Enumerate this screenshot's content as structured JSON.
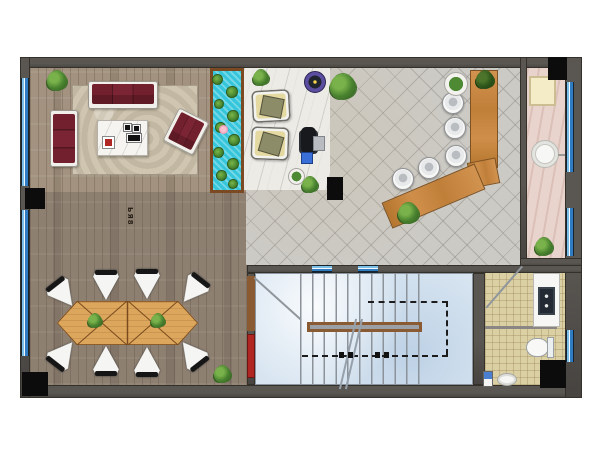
{
  "document": {
    "type": "architectural floor plan, top view, furnished office/showroom level",
    "watermark": "ЬЯ8"
  },
  "colors": {
    "wall": "#5a5652",
    "wall_dark": "#474340",
    "wood": "#a2927f",
    "tile": "#cccac5",
    "marble": "#edebe6",
    "pond_water": "#35c6dc",
    "pond_frame": "#7c4a22",
    "rug": "#cfc5b0",
    "maroon": "#7b2433",
    "cream": "#e5d9a2",
    "desk_edge": "#7e5222",
    "table_wood": "#dca75c",
    "table_line": "#7a4a1e",
    "stairs": "#d8e5f1",
    "tread": "#8b9299",
    "railing": "#8a5a32",
    "bath_floor": "#dbcfa4",
    "pink_floor": "#e8d4cc",
    "window_blue": "#2f7cc2",
    "accent_red": "#b02622",
    "chair_white": "#f5f5f3"
  },
  "rooms": [
    {
      "id": "living-lounge",
      "floor": "wood planks",
      "furniture": [
        "3-seat maroon sofa",
        "maroon chaise",
        "maroon armchair",
        "white coffee table",
        "area rug",
        "plant"
      ]
    },
    {
      "id": "lily-pond",
      "floor": "water feature with lily pads"
    },
    {
      "id": "marble-hall",
      "floor": "white marble",
      "furniture": [
        "2 beige armchairs",
        "office chair",
        "side table",
        "blue crate",
        "purple bowl",
        "planters"
      ]
    },
    {
      "id": "reception-lobby",
      "floor": "diagonal gray tile",
      "furniture": [
        "L-shaped wood bar desk",
        "5 round stools",
        "plants"
      ]
    },
    {
      "id": "side-corridor",
      "floor": "rose marble",
      "furniture": [
        "cream cabinet",
        "round basin",
        "plant"
      ]
    },
    {
      "id": "conference-area",
      "floor": "dark wood planks",
      "furniture": [
        "hexagonal double table",
        "8 white cone chairs",
        "2 table plants"
      ]
    },
    {
      "id": "stairwell",
      "floor": "blue marble",
      "furniture": [
        "stair treads",
        "railing",
        "up-path dashed arrows",
        "door"
      ]
    },
    {
      "id": "bathroom",
      "floor": "beige mosaic",
      "furniture": [
        "vanity with sink",
        "toilet",
        "small sink",
        "cabinet"
      ]
    }
  ],
  "repeats": {
    "windows_left": {
      "cls": "win-v",
      "name": "window-left",
      "items": [
        {
          "x": 21,
          "y": 78,
          "w": 8,
          "h": 108
        },
        {
          "x": 21,
          "y": 210,
          "w": 8,
          "h": 146
        }
      ]
    },
    "windows_right": {
      "cls": "win-v",
      "name": "window-right",
      "items": [
        {
          "x": 566,
          "y": 82,
          "w": 8,
          "h": 90
        },
        {
          "x": 566,
          "y": 208,
          "w": 8,
          "h": 48
        },
        {
          "x": 566,
          "y": 330,
          "w": 8,
          "h": 32
        }
      ]
    },
    "stair_glass": {
      "cls": "win-h",
      "name": "stair-glass-panel",
      "items": [
        {
          "x": 312,
          "y": 265,
          "w": 20,
          "h": 8
        },
        {
          "x": 358,
          "y": 265,
          "w": 20,
          "h": 8
        }
      ]
    },
    "columns": {
      "cls": "col-black",
      "name": "structural-column",
      "items": [
        {
          "x": 25,
          "y": 188,
          "w": 20,
          "h": 21
        },
        {
          "x": 22,
          "y": 372,
          "w": 26,
          "h": 24
        },
        {
          "x": 327,
          "y": 177,
          "w": 16,
          "h": 23
        },
        {
          "x": 548,
          "y": 57,
          "w": 19,
          "h": 23
        },
        {
          "x": 540,
          "y": 360,
          "w": 26,
          "h": 28
        }
      ]
    },
    "stools": {
      "cls": "stool",
      "name": "reception-stool",
      "items": [
        {
          "x": 392,
          "y": 168,
          "d": 22
        },
        {
          "x": 418,
          "y": 157,
          "d": 22
        },
        {
          "x": 445,
          "y": 145,
          "d": 22
        },
        {
          "x": 444,
          "y": 117,
          "d": 22
        },
        {
          "x": 442,
          "y": 92,
          "d": 22
        }
      ]
    },
    "conf_chairs": {
      "cls": "conf-chair",
      "name": "conference-chair",
      "items": [
        {
          "x": 49,
          "y": 279,
          "w": 28,
          "h": 30,
          "r": -38
        },
        {
          "x": 92,
          "y": 270,
          "w": 28,
          "h": 30,
          "r": 0
        },
        {
          "x": 133,
          "y": 269,
          "w": 28,
          "h": 30,
          "r": 0
        },
        {
          "x": 179,
          "y": 275,
          "w": 28,
          "h": 30,
          "r": 38
        },
        {
          "x": 49,
          "y": 339,
          "w": 28,
          "h": 30,
          "r": 218
        },
        {
          "x": 92,
          "y": 346,
          "w": 28,
          "h": 30,
          "r": 180
        },
        {
          "x": 133,
          "y": 347,
          "w": 28,
          "h": 30,
          "r": 180
        },
        {
          "x": 178,
          "y": 339,
          "w": 28,
          "h": 30,
          "r": 142
        }
      ]
    },
    "lily_pads": {
      "cls": "pad",
      "name": "lily-pad",
      "items": [
        {
          "x": 212,
          "y": 74,
          "d": 11
        },
        {
          "x": 226,
          "y": 86,
          "d": 12
        },
        {
          "x": 214,
          "y": 99,
          "d": 10
        },
        {
          "x": 227,
          "y": 110,
          "d": 12
        },
        {
          "x": 215,
          "y": 122,
          "d": 11
        },
        {
          "x": 228,
          "y": 134,
          "d": 12
        },
        {
          "x": 213,
          "y": 147,
          "d": 11
        },
        {
          "x": 227,
          "y": 158,
          "d": 12
        },
        {
          "x": 216,
          "y": 170,
          "d": 11
        },
        {
          "x": 228,
          "y": 179,
          "d": 10
        }
      ]
    },
    "flowers": {
      "cls": "flower",
      "name": "lotus-flower",
      "items": [
        {
          "x": 219,
          "y": 125,
          "d": 9
        }
      ]
    },
    "plants": {
      "cls": "plant",
      "name": "plant",
      "items": [
        {
          "x": 47,
          "y": 71,
          "d": 20
        },
        {
          "x": 253,
          "y": 70,
          "d": 16
        },
        {
          "x": 330,
          "y": 74,
          "d": 26
        },
        {
          "x": 444,
          "y": 72,
          "d": 24,
          "v": "planter"
        },
        {
          "x": 476,
          "y": 71,
          "d": 18,
          "v": "dark"
        },
        {
          "x": 398,
          "y": 203,
          "d": 21
        },
        {
          "x": 535,
          "y": 238,
          "d": 18
        },
        {
          "x": 214,
          "y": 366,
          "d": 17
        },
        {
          "x": 88,
          "y": 314,
          "d": 14
        },
        {
          "x": 151,
          "y": 314,
          "d": 14
        },
        {
          "x": 288,
          "y": 168,
          "d": 17,
          "v": "planter"
        },
        {
          "x": 302,
          "y": 177,
          "d": 16
        }
      ]
    },
    "dash_arrows": {
      "cls": "darrow",
      "name": "stair-direction-arrow",
      "items": [
        {
          "x": 339,
          "y": 352,
          "w": 14,
          "h": 6
        },
        {
          "x": 375,
          "y": 352,
          "w": 14,
          "h": 6
        }
      ]
    }
  }
}
